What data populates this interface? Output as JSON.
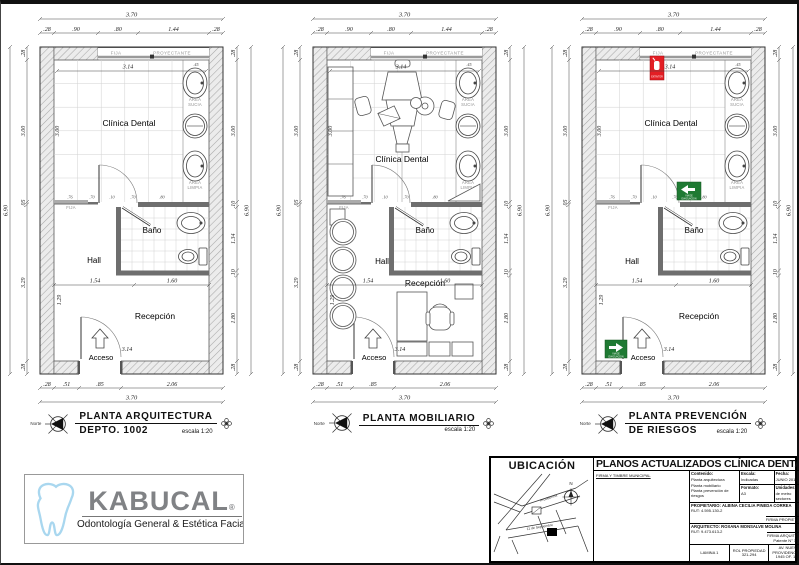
{
  "sheet": {
    "background": "#ffffff",
    "border_color": "#111111"
  },
  "dims": {
    "top_total": "3.70",
    "bottom_total": "3.70",
    "side_total": "6.90",
    "top": [
      ".28",
      ".90",
      ".80",
      "1.44",
      ".28"
    ],
    "bottom": [
      ".28",
      ".51",
      ".85",
      "2.06"
    ],
    "left": [
      ".28",
      "3.00",
      ".05",
      "3.29",
      ".28"
    ],
    "right": [
      ".28",
      "3.00",
      ".10",
      "1.34",
      ".10",
      "1.80",
      ".28"
    ],
    "partition": [
      ".76",
      ".70",
      ".10",
      ".70",
      ".80"
    ],
    "interior": {
      "clinic_w": "3.14",
      "clinic_h": "3.00",
      "hall_w": "1.54",
      "recep_w": "1.60",
      "hall_h": "1.29",
      "acceso_w": "3.14",
      "strip": ".45"
    }
  },
  "rooms": {
    "clinic": "Clínica Dental",
    "bath": "Baño",
    "hall": "Hall",
    "reception": "Recepción",
    "access": "Acceso",
    "area": "AREA",
    "sucia": "SUCIA",
    "limpia": "LIMPIA",
    "fija": "FIJA",
    "proyectante": "PROYECTANTE"
  },
  "safety": {
    "extintor": "EXTINTOR",
    "via1": "VIA DE",
    "via2": "EVACUACION",
    "green": "#1f7a33",
    "red": "#e31e24"
  },
  "plans": [
    {
      "id": "arquitectura",
      "north": "Norte",
      "title1": "PLANTA ARQUITECTURA",
      "title2": "DEPTO. 1002",
      "scale": "escala 1:20"
    },
    {
      "id": "mobiliario",
      "north": "Norte",
      "title1": "PLANTA MOBILIARIO",
      "title2": "",
      "scale": "escala 1:20"
    },
    {
      "id": "prevencion",
      "north": "Norte",
      "title1": "PLANTA PREVENCIÓN",
      "title2": "DE RIESGOS",
      "scale": "escala 1:20"
    }
  ],
  "logo": {
    "name": "KABUCAL",
    "reg": "®",
    "tagline": "Odontología General & Estética Facial",
    "brand_gray": "#808285",
    "tooth_blue": "#a9d7ef"
  },
  "titleblock": {
    "ubicacion": "UBICACIÓN",
    "map_north": "N",
    "map_street1": "Providencia",
    "map_street2": "11 de Septiembre",
    "title": "PLANOS ACTUALIZADOS CLÍNICA DENTAL",
    "firma_municipal": "FIRMA Y TIMBRE MUNICIPAL",
    "contenido_label": "Contenido:",
    "contenido1": "Planta arquitectura",
    "contenido2": "Planta mobiliario",
    "contenido3": "Planta prevención de riesgos",
    "escala_label": "Escala:",
    "escala": "Indicadas",
    "fecha_label": "Fecha:",
    "fecha": "JUNIO 2014",
    "formato_label": "Formato:",
    "formato": "A3",
    "unidades_label": "Unidades:",
    "unidades": "de metro sectores",
    "propietario": "PROPIETARIO: ALBINA CECILIA PINEDA CORREA",
    "propietario_rut": "RUT: 4.595.130-2",
    "firma_propietario": "FIRMA PROPIETARIO",
    "arquitecto": "ARQUITECTO: ROXANA MONSALVE MOLINA",
    "arquitecto_rut": "RUT: 9.473.613-2",
    "firma_arquitecto": "FIRMA ARQUITECTO",
    "patente": "Patente N° 13.679",
    "lamina": "LAMINA 1",
    "rol": "ROL PROPIEDAD 321-294",
    "direccion": "AV. NUEVA PROVIDENCIA N° 1945 OF. 1620"
  }
}
